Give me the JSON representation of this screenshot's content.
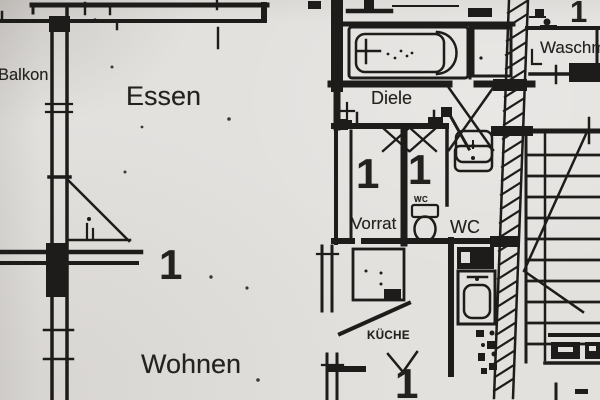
{
  "colors": {
    "paper": "#e3e1de",
    "ink": "#1d1c1a"
  },
  "labels": {
    "balkon": "Balkon",
    "essen": "Essen",
    "diele": "Diele",
    "waschraum": "Waschm",
    "vorrat": "Vorrat",
    "wc": "WC",
    "wc_small": "WC",
    "kueche": "KÜCHE",
    "wohnen": "Wohnen"
  },
  "room_numbers": {
    "waschraum": "1",
    "vorrat": "1",
    "wc": "1",
    "wohnen": "1",
    "kueche": "1"
  }
}
